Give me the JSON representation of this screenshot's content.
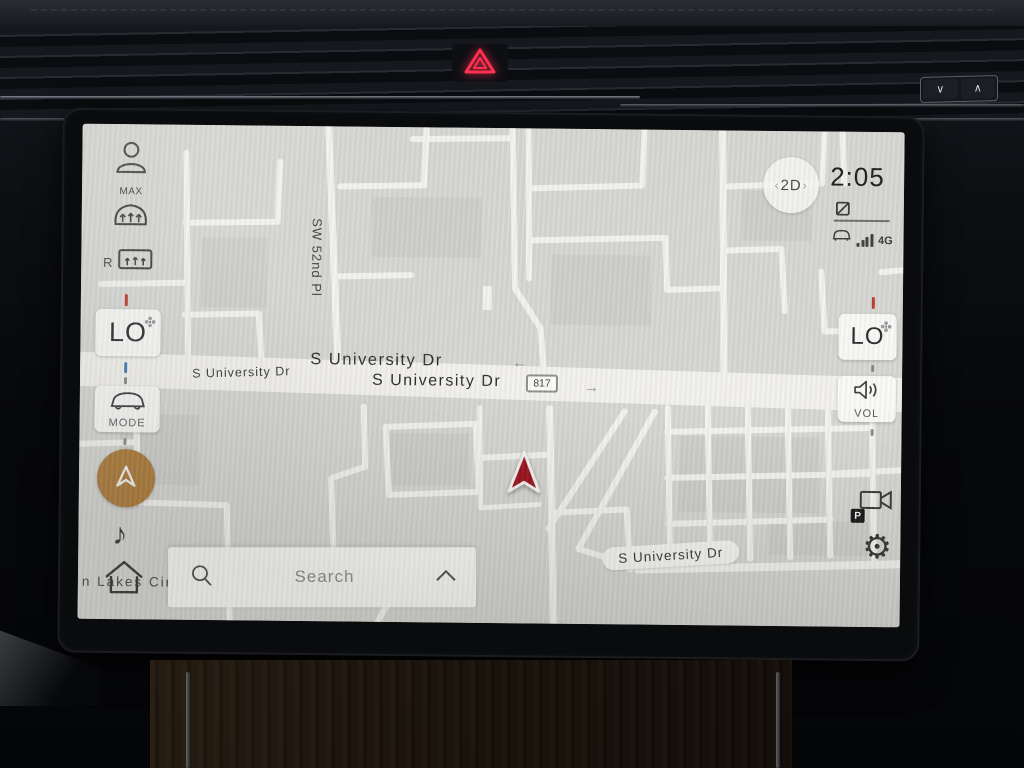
{
  "dash": {
    "rocker_down": "∨",
    "rocker_up": "∧"
  },
  "left_panel": {
    "max_label": "MAX",
    "rear_label": "R",
    "driver_temp": "LO",
    "mode_label": "MODE",
    "music_glyph": "♪"
  },
  "right_panel": {
    "view_mode": "2D",
    "chevron_left": "‹",
    "chevron_right": "›",
    "time": "2:05",
    "network": "4G",
    "passenger_temp": "LO",
    "volume_label": "VOL",
    "parking_badge": "P",
    "gear_glyph": "⚙"
  },
  "search": {
    "placeholder": "Search"
  },
  "map": {
    "street_vertical": "SW 52nd Pl",
    "street_small": "S University Dr",
    "street_upper": "S University Dr",
    "street_lower": "S University Dr",
    "arrow_left": "←",
    "arrow_right": "→",
    "highway_shield": "817",
    "street_bubble": "S University Dr",
    "street_partial": "n Lakes Cir"
  },
  "colors": {
    "nav_button": "#ad7b3a",
    "vehicle_marker": "#9c1420",
    "hazard": "#ff3050",
    "map_bg": "#d6d6d3",
    "road": "#f3f2ef"
  }
}
